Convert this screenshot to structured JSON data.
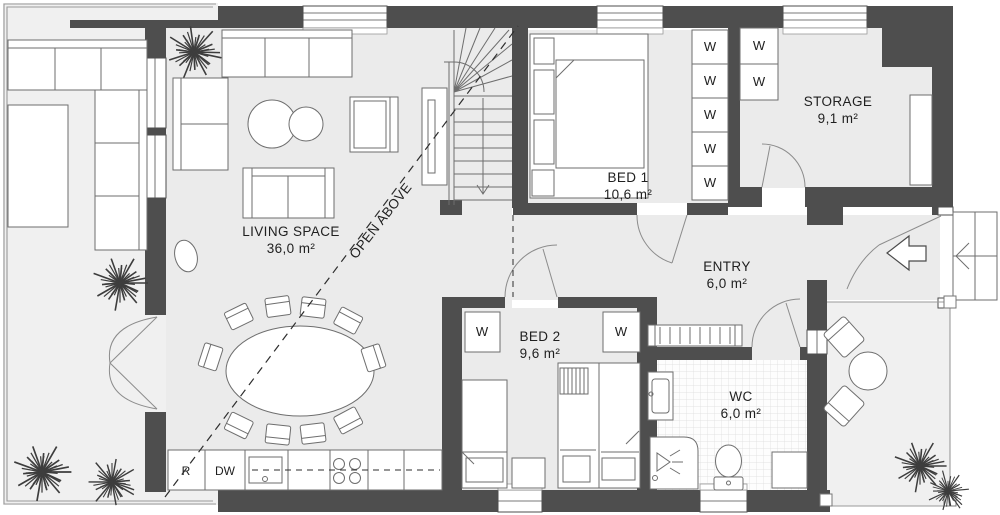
{
  "rooms": [
    {
      "name": "LIVING SPACE",
      "area": "36,0 m²"
    },
    {
      "name": "BED 1",
      "area": "10,6 m²"
    },
    {
      "name": "BED 2",
      "area": "9,6 m²"
    },
    {
      "name": "STORAGE",
      "area": "9,1 m²"
    },
    {
      "name": "ENTRY",
      "area": "6,0 m²"
    },
    {
      "name": "WC",
      "area": "6,0 m²"
    }
  ],
  "annotations": {
    "open_above": "OPEN ABOVE"
  },
  "fixtures": {
    "wardrobe": "W",
    "refrigerator": "R",
    "dishwasher": "DW"
  },
  "colors": {
    "wall": "#4e4e4e",
    "floor": "#ebebeb",
    "outdoor": "#f0f0f0",
    "outline": "#6e6e6e",
    "text": "#1f1f1f"
  }
}
